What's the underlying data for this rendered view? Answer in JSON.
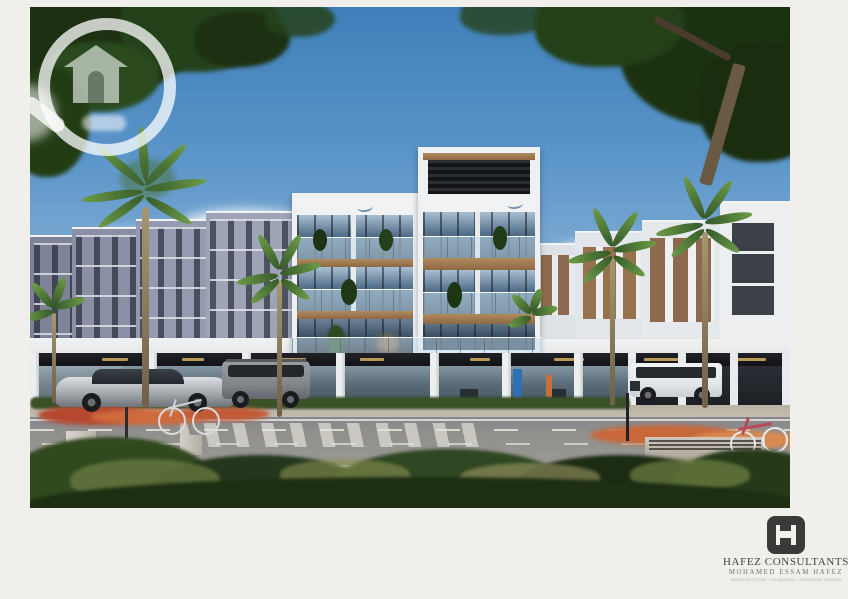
{
  "page": {
    "background_color": "#f0efec"
  },
  "photo": {
    "description": "Architectural exterior rendering of a modern mixed-use residential complex with ground-floor retail, palm trees, parked cars, bicycles, a street and foreground shrubs",
    "width_px": 760,
    "height_px": 501
  },
  "watermark": {
    "name": "magnifier-house-watermark",
    "color": "rgba(255,255,255,0.75)"
  },
  "scene": {
    "sky_top": "#3f7fba",
    "sky_horizon": "#dce9f2",
    "left_wing_color": "#9096ab",
    "right_wing_color": "#e9ecef",
    "wood_accent": "#a57b52",
    "glass_color": "#55718c",
    "signage_band": "#17181c",
    "road_color": "#908f8b",
    "shrub_color": "#2b4220",
    "flower_color": "#cc6a3c",
    "objects": [
      "apartment buildings",
      "central tower with roof pergola",
      "retail storefronts",
      "palm trees",
      "silver sports car",
      "gray suv",
      "white suv",
      "two bicycles",
      "crosswalk",
      "foreground shrubs"
    ]
  },
  "branding": {
    "company": "HAFEZ CONSULTANTS",
    "person": "MOHAMED ESSAM HAFEZ",
    "tagline": "ARCHITECTURE • PLANNING • INTERIOR DESIGN",
    "logo_color": "#3a3a38",
    "text_color": "#444340"
  }
}
